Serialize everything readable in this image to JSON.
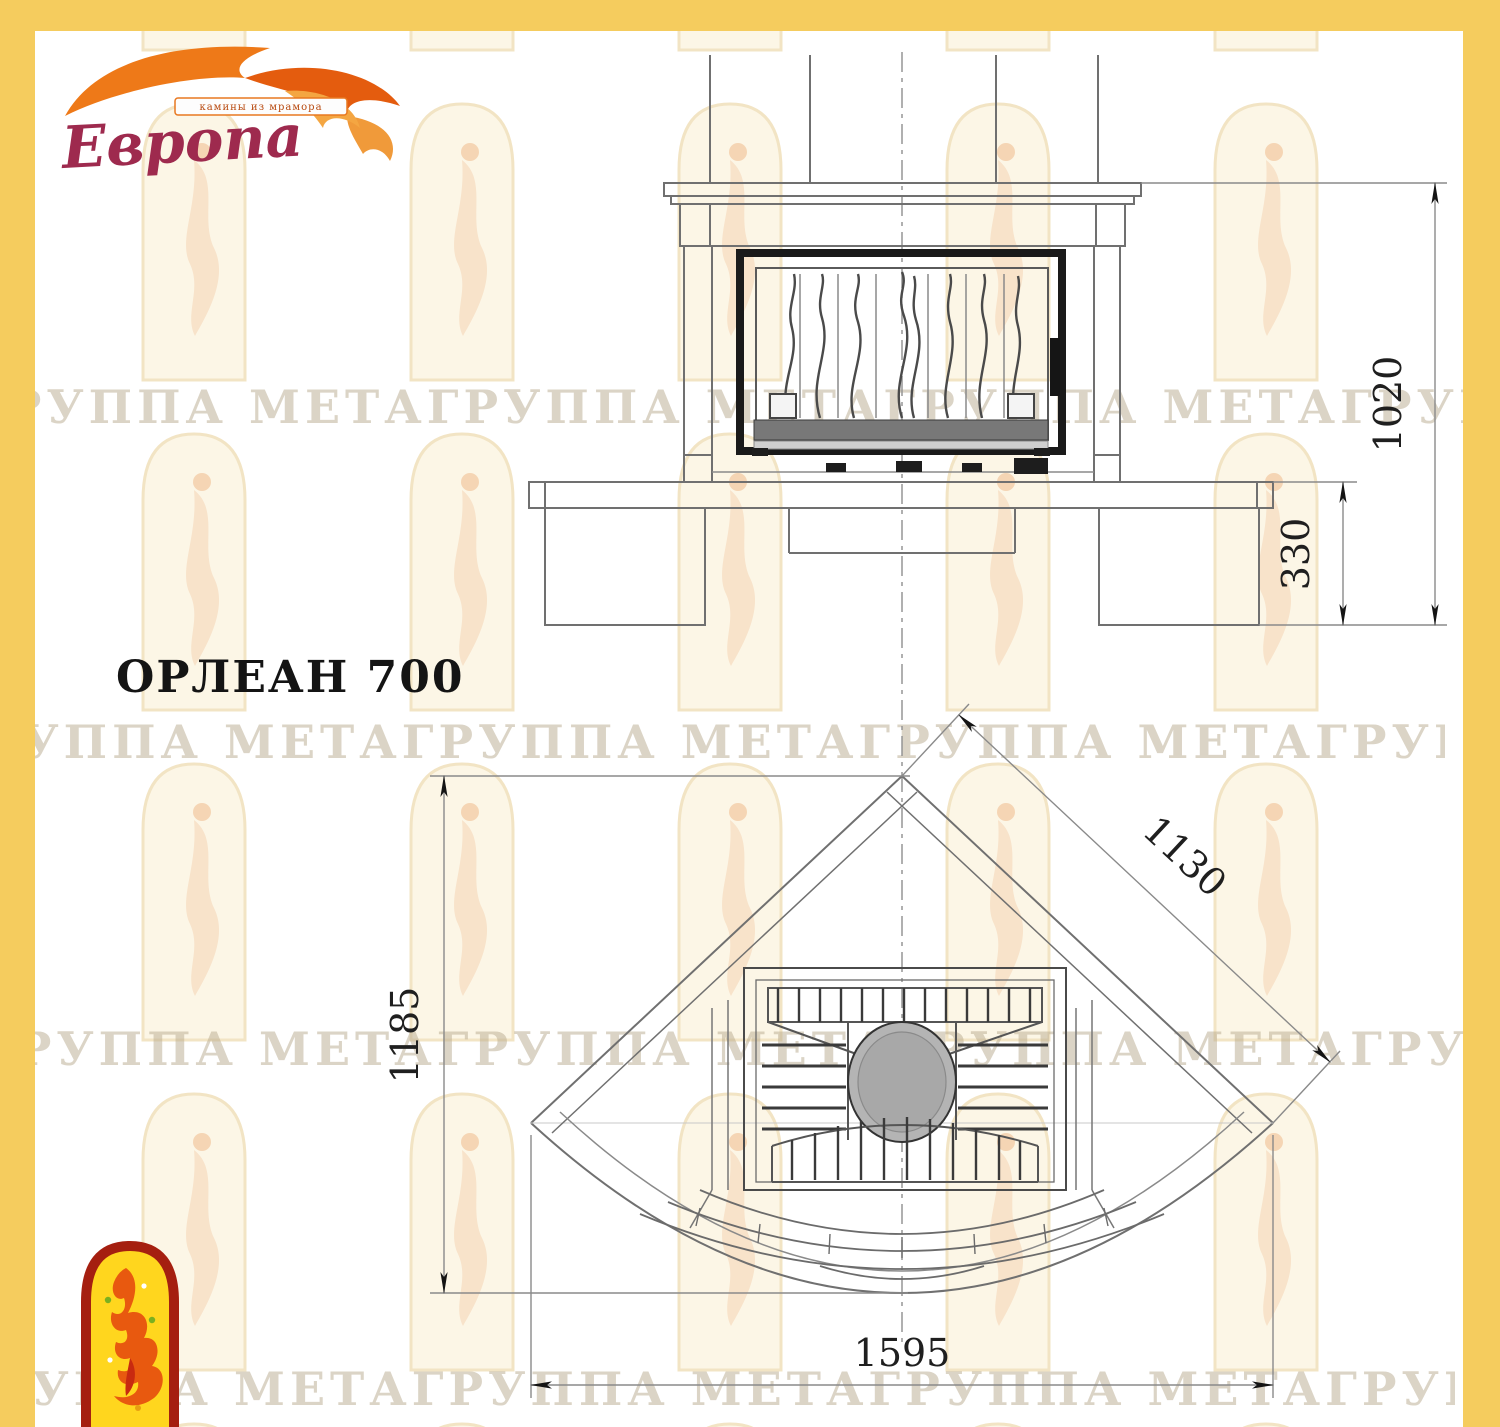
{
  "colors": {
    "border_yellow": "#f5cc5e",
    "line_gray": "#6b6b6b",
    "frame_black": "#1a1a1a",
    "logo_maroon": "#9e2a4e",
    "flame_orange": "#e8650f",
    "emblem_red": "#a51f10",
    "emblem_yellow": "#ffd61e",
    "watermark_tan": "#b8aa8e"
  },
  "logo": {
    "brand": "Европа",
    "tagline": "камины из мрамора"
  },
  "title": "ОРЛЕАН 700",
  "watermark": {
    "line": "ГРУППА МЕТАГРУППА МЕТАГРУППА МЕТАГРУППА МЕТАГРУППА МЕТА"
  },
  "front_view": {
    "dim_height": "1020",
    "dim_hearth_height": "330"
  },
  "plan_view": {
    "dim_depth": "1185",
    "dim_diagonal": "1130",
    "dim_width": "1595"
  }
}
